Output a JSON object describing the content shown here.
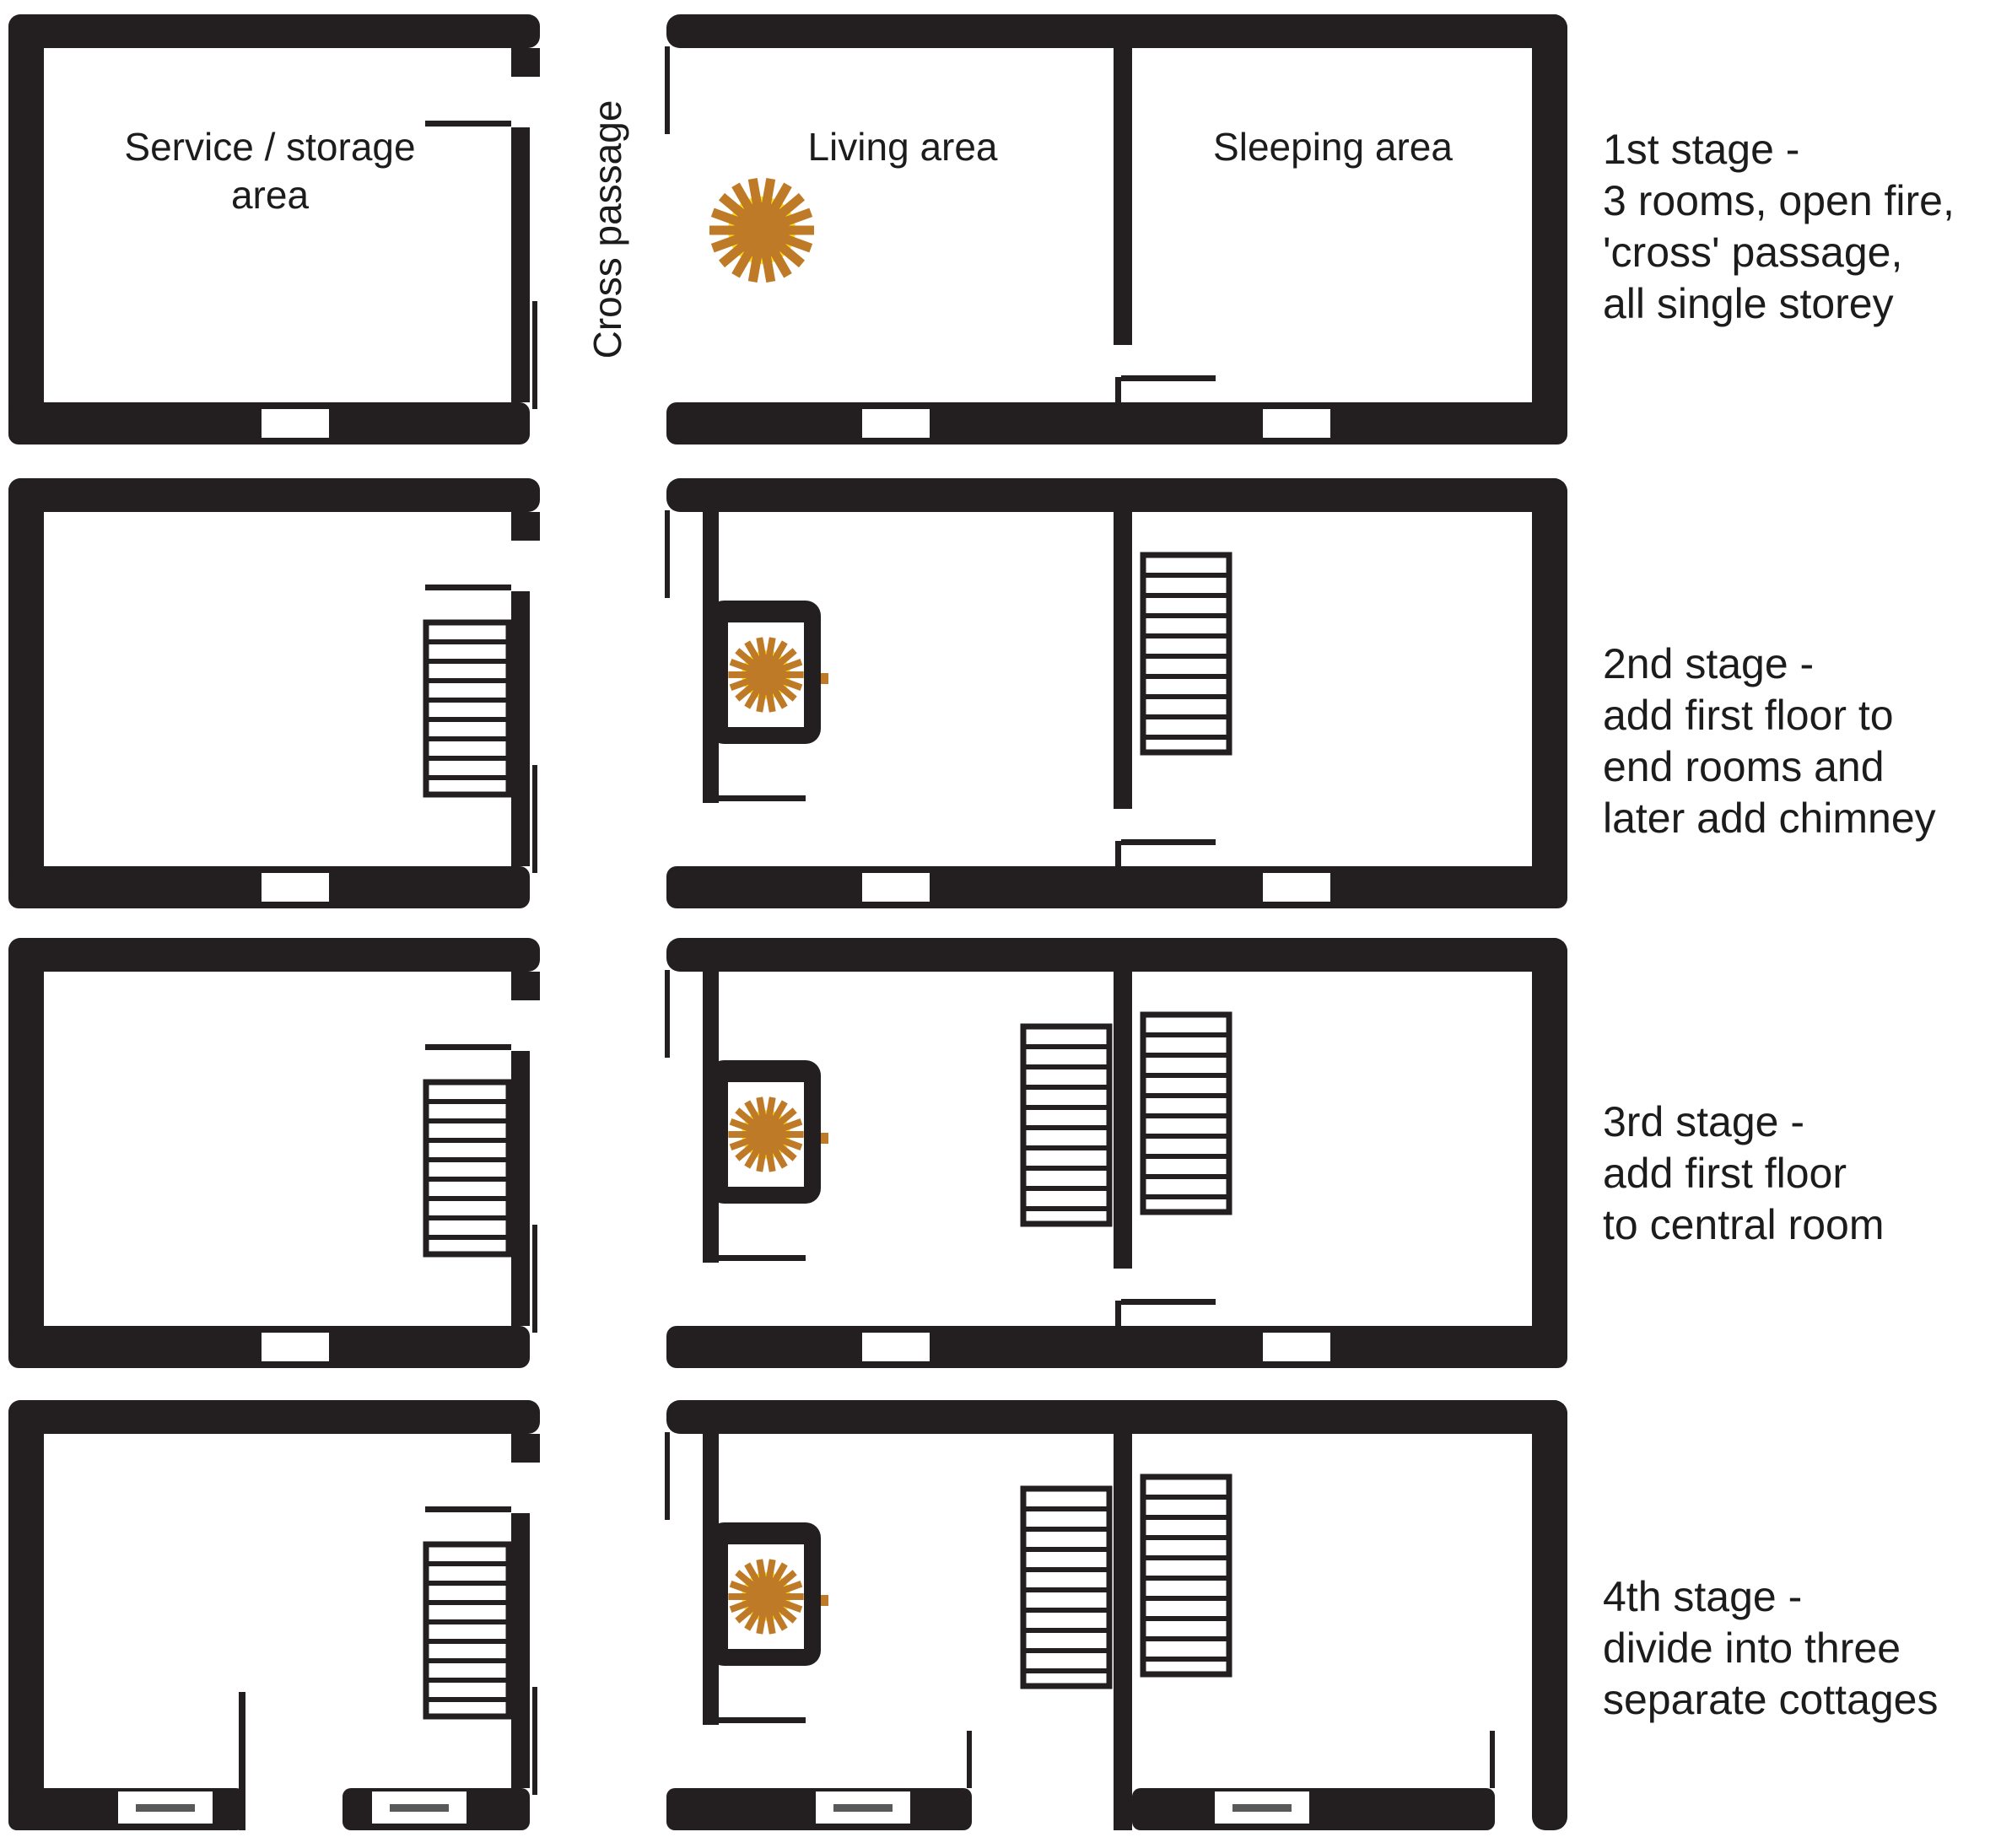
{
  "diagram": {
    "passage_label": "Cross passage",
    "rooms": {
      "service_line1": "Service / storage",
      "service_line2": "area",
      "living": "Living area",
      "sleeping": "Sleeping area"
    },
    "stages": [
      {
        "caption_lines": [
          "1st stage -",
          "3 rooms, open fire,",
          "'cross' passage,",
          "all single storey"
        ]
      },
      {
        "caption_lines": [
          "2nd stage -",
          "add first floor to",
          "end rooms and",
          "later add chimney"
        ]
      },
      {
        "caption_lines": [
          "3rd stage -",
          "add first floor",
          "to central room"
        ]
      },
      {
        "caption_lines": [
          "4th stage -",
          "divide into three",
          "separate cottages"
        ]
      }
    ]
  },
  "icons": {
    "fire": "fire-icon",
    "staircase": "staircase-icon",
    "window": "window-opening-icon",
    "door_leaf": "door-leaf-icon"
  },
  "colors": {
    "wall": "#231f20",
    "fire-rays": "#bf7a28",
    "fire-glow": "#ffdd15",
    "window-dash": "#58595b",
    "text": "#1c1c1c"
  }
}
